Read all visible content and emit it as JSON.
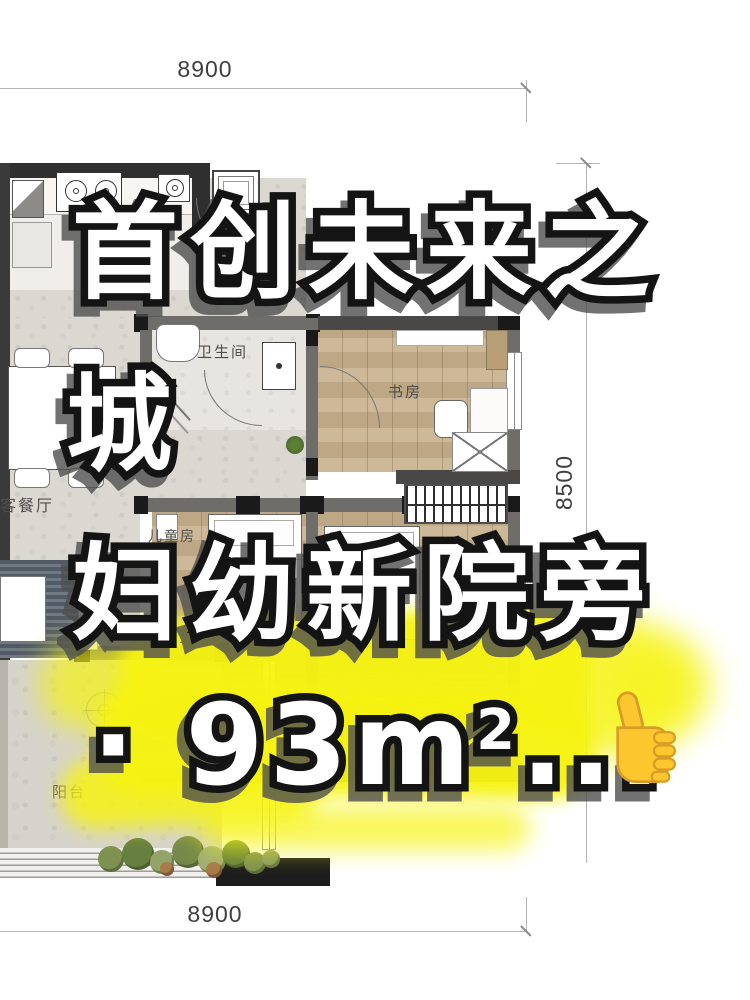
{
  "page": {
    "background": "#ffffff"
  },
  "dimensions": {
    "top": "8900",
    "bottom": "8900",
    "right": "8500"
  },
  "floor_plan": {
    "rooms": [
      {
        "id": "bathroom",
        "label": "卫生间"
      },
      {
        "id": "study",
        "label": "书房"
      },
      {
        "id": "living-dining",
        "label": "客餐厅"
      },
      {
        "id": "kids-room",
        "label": "儿童房"
      },
      {
        "id": "balcony",
        "label": "阳台"
      }
    ]
  },
  "overlay": {
    "line1": "首创未来之",
    "line2": "城",
    "line3": "妇幼新院旁",
    "line4_prefix": "· 93m",
    "line4_sup": "2",
    "line4_suffix": "...",
    "thumbs_up_icon": "👍",
    "highlight_color": "#f6f312",
    "text_fill": "#ffffff",
    "text_outline": "#141414"
  }
}
